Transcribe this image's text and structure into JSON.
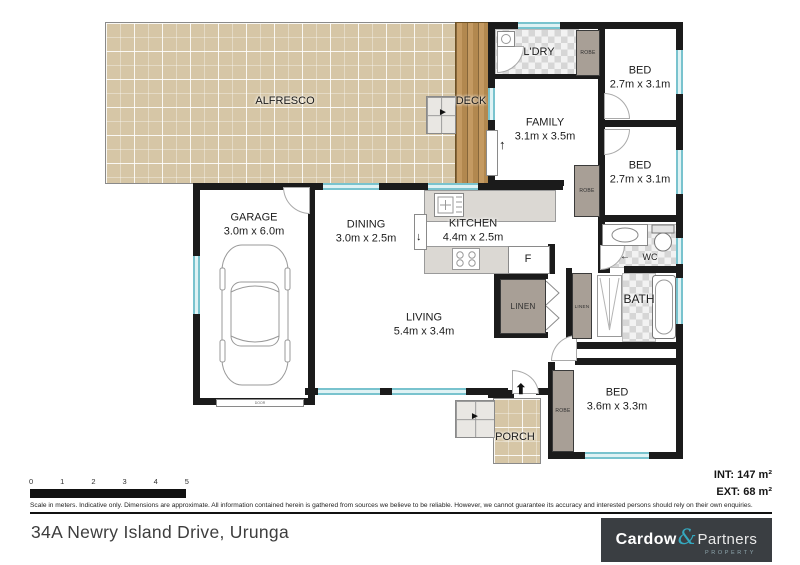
{
  "meta": {
    "address": "34A Newry Island Drive, Urunga"
  },
  "rooms": {
    "alfresco": {
      "label": "ALFRESCO"
    },
    "deck": {
      "label": "DECK"
    },
    "ldry": {
      "label": "L'DRY"
    },
    "bed1": {
      "label": "BED",
      "dims": "2.7m x 3.1m"
    },
    "bed2": {
      "label": "BED",
      "dims": "2.7m x 3.1m"
    },
    "family": {
      "label": "FAMILY",
      "dims": "3.1m x 3.5m"
    },
    "garage": {
      "label": "GARAGE",
      "dims": "3.0m x 6.0m"
    },
    "dining": {
      "label": "DINING",
      "dims": "3.0m x 2.5m"
    },
    "kitchen": {
      "label": "KITCHEN",
      "dims": "4.4m x 2.5m"
    },
    "living": {
      "label": "LIVING",
      "dims": "5.4m x 3.4m"
    },
    "bed3": {
      "label": "BED",
      "dims": "3.6m x 3.3m"
    },
    "bath": {
      "label": "BATH"
    },
    "wc": {
      "label": "WC"
    },
    "porch": {
      "label": "PORCH"
    },
    "linen1": {
      "label": "LINEN"
    },
    "linen2": {
      "label": "LINEN"
    },
    "robe1": {
      "label": "ROBE"
    },
    "robe2": {
      "label": "ROBE"
    },
    "robe3": {
      "label": "ROBE"
    },
    "fridge": {
      "label": "F"
    },
    "garage_door": {
      "label": "DOOR"
    }
  },
  "icons": {
    "entry_arrow": "⬆",
    "slider_arrow": "↑",
    "kitchen_arrow": "↓",
    "wc_arrow": "←",
    "deck_steps_arrow": "►",
    "porch_steps_arrow": "►"
  },
  "scalebar": {
    "ticks": [
      "0",
      "1",
      "2",
      "3",
      "4",
      "5"
    ]
  },
  "areas": {
    "int": "INT: 147 m²",
    "ext": "EXT: 68 m²"
  },
  "disclaimer": "Scale in meters. Indicative only. Dimensions are approximate. All information contained herein is gathered from sources we believe to be reliable. However, we cannot guarantee its accuracy and interested persons should rely on their own enquiries.",
  "logo": {
    "name_a": "Cardow",
    "amp": "&",
    "name_b": "Partners",
    "tagline": "PROPERTY"
  },
  "colors": {
    "wall": "#1b1b1b",
    "window": "#79c3ce",
    "closet": "#a89f96",
    "paver": "#d6c6a6",
    "deck": "#b2884f",
    "logo_bg": "#3a3e42",
    "teal": "#35a8bf"
  }
}
